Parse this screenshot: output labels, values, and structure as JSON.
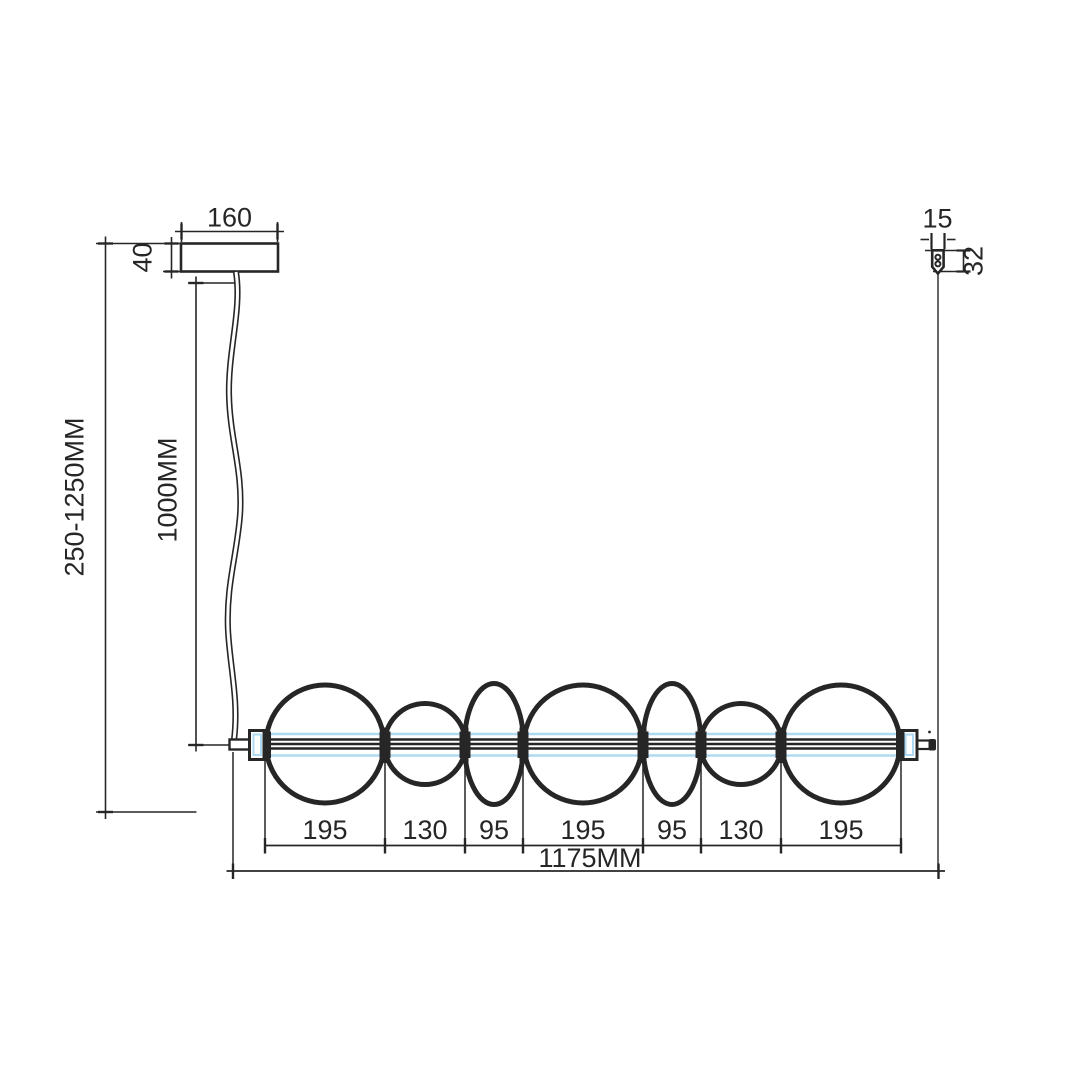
{
  "dims": {
    "canopy_width": "160",
    "canopy_height": "40",
    "suspension_range": "250-1250MM",
    "cable_length": "1000MM",
    "gripper_width": "15",
    "gripper_height": "32",
    "overall_length": "1175MM",
    "segments": [
      "195",
      "130",
      "95",
      "195",
      "95",
      "130",
      "195"
    ]
  },
  "colors": {
    "ink": "#262626",
    "tube_highlight": "#aed9f2",
    "background": "#ffffff"
  }
}
